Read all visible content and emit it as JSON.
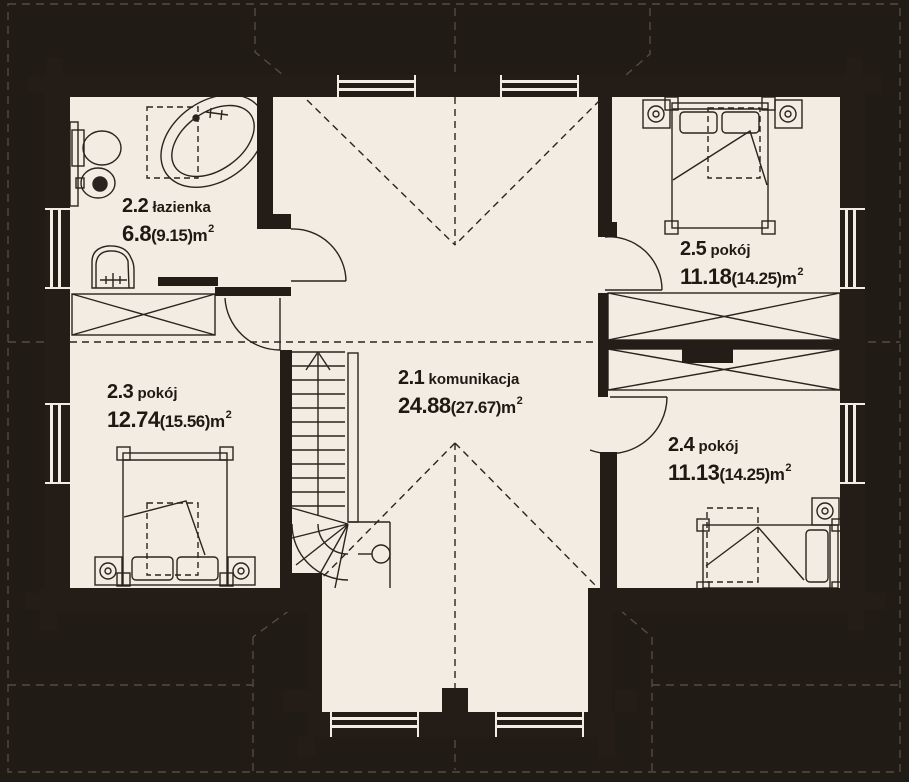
{
  "colors": {
    "background": "#211b15",
    "wall": "#241d17",
    "floor": "#f2ece3",
    "linework": "#2a241e",
    "roof_dash_outside": "#4e463e"
  },
  "rooms": [
    {
      "id": "2.1",
      "name": "komunikacja",
      "area": "24.88",
      "area_alt": "(27.67)",
      "unit": "m",
      "exp": "2"
    },
    {
      "id": "2.2",
      "name": "łazienka",
      "area": "6.8",
      "area_alt": "(9.15)",
      "unit": "m",
      "exp": "2"
    },
    {
      "id": "2.3",
      "name": "pokój",
      "area": "12.74",
      "area_alt": "(15.56)",
      "unit": "m",
      "exp": "2"
    },
    {
      "id": "2.4",
      "name": "pokój",
      "area": "11.13",
      "area_alt": "(14.25)",
      "unit": "m",
      "exp": "2"
    },
    {
      "id": "2.5",
      "name": "pokój",
      "area": "11.18",
      "area_alt": "(14.25)",
      "unit": "m",
      "exp": "2"
    }
  ]
}
